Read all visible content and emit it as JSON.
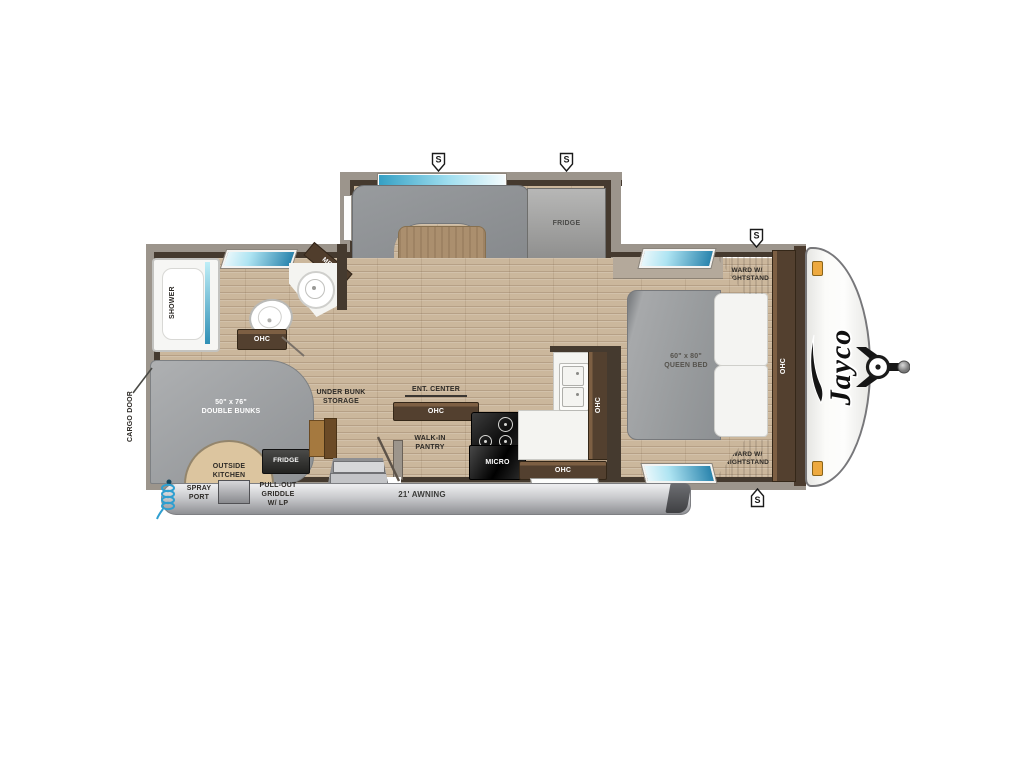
{
  "colors": {
    "floor_wood": "#cbb79c",
    "wall_gray": "#9c958c",
    "wall_dark": "#453a2f",
    "cabinet_brown": "#53402f",
    "upholstery_gray": "#8d9093",
    "window_teal": "#2a84ad",
    "awning_gray": "#c9cacd",
    "outside_kitchen_tan": "#dcc59f",
    "marker_orange": "#eda93f",
    "spray_port_blue": "#2f9fd0"
  },
  "speakers": {
    "label": "S"
  },
  "slide_out": {
    "fridge": "FRIDGE"
  },
  "bathroom": {
    "shower": "SHOWER",
    "med": "MED",
    "ohc": "OHC"
  },
  "rear": {
    "cargo_door": "CARGO DOOR",
    "double_bunks": "50\" x 76\"\nDOUBLE BUNKS",
    "under_bunk_storage": "UNDER BUNK\nSTORAGE",
    "outside_kitchen": "OUTSIDE\nKITCHEN",
    "outside_fridge": "FRIDGE",
    "spray_port": "SPRAY\nPORT",
    "pull_out_griddle": "PULL-OUT\nGRIDDLE\nW/ LP"
  },
  "kitchen": {
    "ent_center": "ENT. CENTER",
    "ent_center_ohc": "OHC",
    "walk_in_pantry": "WALK-IN\nPANTRY",
    "micro": "MICRO",
    "ohc_lower": "OHC",
    "ohc_side": "OHC"
  },
  "bedroom": {
    "queen_bed": "60\" x 80\"\nQUEEN BED",
    "ward_top": "WARD W/\nNIGHTSTAND",
    "ward_bottom": "WARD W/\nNIGHTSTAND",
    "ohc": "OHC"
  },
  "exterior": {
    "awning": "21' AWNING",
    "brand": "Jayco"
  }
}
